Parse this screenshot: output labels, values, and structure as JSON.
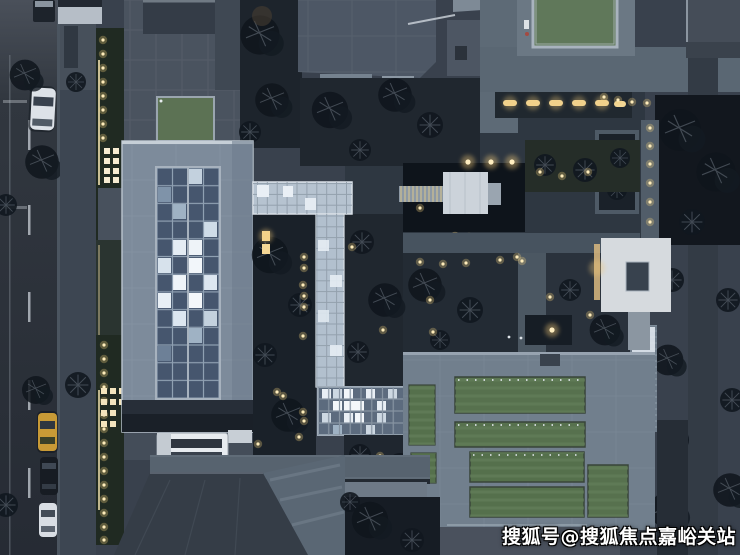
{
  "scene": {
    "type": "aerial-photograph",
    "description": "Top-down dusk aerial view of a modern residential courtyard complex: street with parked cars at left, blue-gray roofed buildings with lit glass atriums, green roof lawns, courtyards with trees and warm path lights",
    "time_of_day": "dusk"
  },
  "watermark": {
    "text": "搜狐号@搜狐焦点嘉峪关站",
    "color": "#ffffff",
    "outline": "#000000"
  },
  "palette": {
    "pavement": "#3e4754",
    "roof_gray": "#7d8b9b",
    "glass_lit": "#eef3f8",
    "lawn_green": "#57714e",
    "pool_green": "#60785a",
    "warm_light": "#ffe9b4",
    "night_shadow": "#161c24",
    "taxi_yellow": "#c89a36",
    "white_car": "#dde2e8"
  }
}
